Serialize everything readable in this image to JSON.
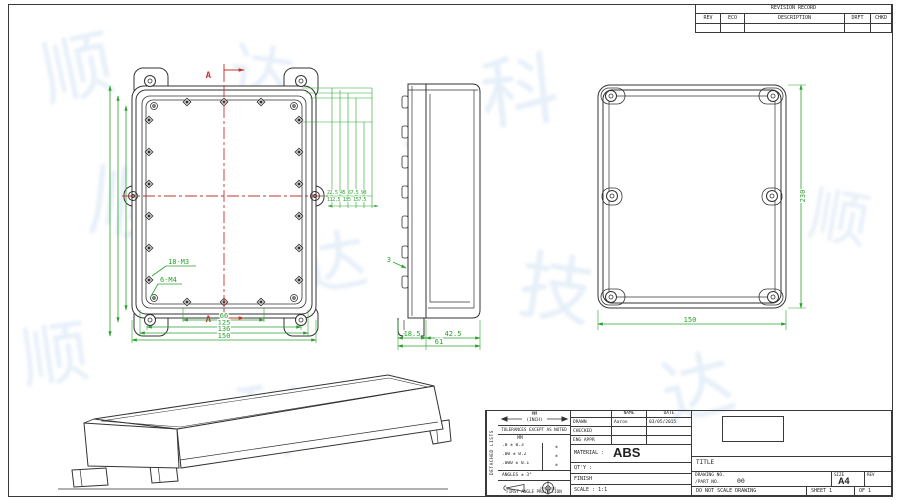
{
  "revision_table": {
    "title": "REVISION RECORD",
    "columns": [
      "REV",
      "ECO",
      "DESCRIPTION",
      "DRFT",
      "CHKD"
    ]
  },
  "views": {
    "top_view": {
      "label_18m3": "18-M3",
      "label_6m4": "6-M4",
      "section_label_top": "A",
      "section_label_bottom": "A",
      "dim_66": "66",
      "dim_125": "125",
      "dim_136": "136",
      "dim_150": "150",
      "dim_cluster_row1": "22.5 45 67.5 90",
      "dim_cluster_row2": "112.5 135 157.5"
    },
    "side_view": {
      "wall_dim": "3",
      "dim_left": "18.5",
      "dim_right": "42.5",
      "dim_total": "61"
    },
    "lid_view": {
      "dim_width": "150",
      "dim_height": "230"
    }
  },
  "title_block": {
    "strip_text": "DETACHED LISTS",
    "units_mm": "MM",
    "units_inch": "(INCH)",
    "tolerance_note": "TOLERANCES EXCEPT AS NOTED",
    "tol_header": "MM",
    "tol_rows": [
      {
        "mm": ".0 ± 0.3",
        "inch": "±"
      },
      {
        "mm": ".00 ± 0.2",
        "inch": "±"
      },
      {
        "mm": ".000 ± 0.1",
        "inch": "±"
      }
    ],
    "angles": "ANGLES ± 3°",
    "projection": "FIRST ANGLE PROJECTION",
    "name_header": "NAME",
    "date_header": "DATE",
    "rows": [
      {
        "label": "DRAWN",
        "name": "Aaron",
        "date": "03/05/2015"
      },
      {
        "label": "CHECKED",
        "name": "",
        "date": ""
      },
      {
        "label": "ENG APPR",
        "name": "",
        "date": ""
      }
    ],
    "material_label": "MATERIAL :",
    "material_value": "ABS",
    "qty_label": "QT'Y :",
    "finish_label": "FINISH",
    "scale_label": "SCALE : 1:1",
    "title_label": "TITLE",
    "drawing_no_label": "DRAWING NO.",
    "part_no_label": "/PART  NO.",
    "part_no_value": "00",
    "size_label": "SIZE",
    "size_value": "A4",
    "rev_label": "REV",
    "do_not_scale": "DO NOT SCALE DRAWING",
    "sheet_label": "SHEET 1",
    "of_label": "OF 1"
  },
  "watermark": {
    "glyphs": [
      "顺",
      "达",
      "科",
      "技",
      "顺",
      "达",
      "技",
      "顺",
      "科",
      "达",
      "顺",
      "达"
    ]
  },
  "colors": {
    "dim_green": "#2aa12e",
    "centerline_red": "#c2342e",
    "line": "#3a3a3a",
    "watermark_blue": "#d2e2f3"
  }
}
